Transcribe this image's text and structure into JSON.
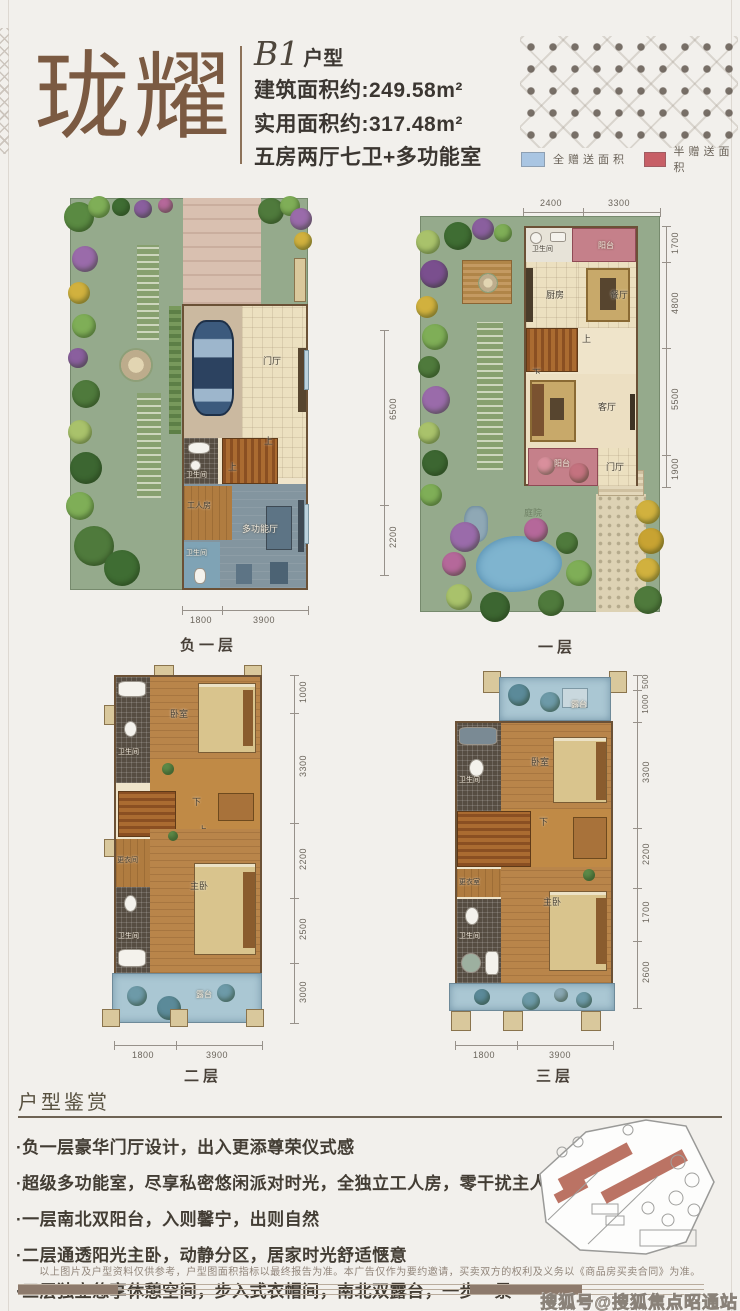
{
  "header": {
    "title": "珑耀",
    "unit_code": "B1",
    "unit_suffix": "户型",
    "line1": "建筑面积约:249.58m²",
    "line2": "实用面积约:317.48m²",
    "line3": "五房两厅七卫+多功能室",
    "legend": [
      {
        "label": "全赠送面积",
        "color": "#a9c5e2"
      },
      {
        "label": "半赠送面积",
        "color": "#c75f66"
      }
    ]
  },
  "plans": [
    {
      "caption": "负一层",
      "rooms": {
        "entry": "门厅",
        "bath1": "卫生间",
        "worker": "工人房",
        "multi": "多功能厅",
        "bath2": "卫生间"
      },
      "stair_up": "上",
      "dims_right": [
        "6500",
        "2200"
      ],
      "dims_bottom": [
        "1800",
        "3900"
      ]
    },
    {
      "caption": "一层",
      "rooms": {
        "bath": "卫生间",
        "balcony_n": "阳台",
        "kitchen": "厨房",
        "dining": "餐厅",
        "living": "客厅",
        "balcony_s": "阳台",
        "entry": "门厅",
        "courtyard": "庭院"
      },
      "stair_up": "上",
      "stair_down": "下",
      "dims_top": [
        "2400",
        "3300"
      ],
      "dims_right": [
        "1700",
        "4800",
        "5500",
        "1900"
      ]
    },
    {
      "caption": "二层",
      "rooms": {
        "bedroom": "卧室",
        "bath1": "卫生间",
        "closet": "更衣间",
        "master": "主卧",
        "bath2": "卫生间",
        "terrace": "露台"
      },
      "stair_up": "上",
      "stair_down": "下",
      "dims_right": [
        "1000",
        "3300",
        "2200",
        "2500",
        "3000"
      ],
      "dims_bottom": [
        "1800",
        "3900"
      ]
    },
    {
      "caption": "三层",
      "rooms": {
        "terrace_n": "露台",
        "bath1": "卫生间",
        "bedroom": "卧室",
        "closet": "更衣室",
        "master": "主卧",
        "bath2": "卫生间"
      },
      "stair_down": "下",
      "dims_right": [
        "500",
        "1000",
        "3300",
        "2200",
        "1700",
        "2600"
      ],
      "dims_bottom": [
        "1800",
        "3900"
      ]
    }
  ],
  "appreciation": {
    "title": "户型鉴赏",
    "bullets": [
      "·负一层豪华门厅设计，出入更添尊荣仪式感",
      "·超级多功能室，尽享私密悠闲派对时光，全独立工人房，零干扰主人生活",
      "·一层南北双阳台，入则馨宁，出则自然",
      "·二层通透阳光主卧，动静分区，居家时光舒适惬意",
      "·三层独立悠享休憩空间，步入式衣帽间，南北双露台，一步一景"
    ]
  },
  "footer": {
    "disclaimer": "以上图片及户型资料仅供参考，户型图面积指标以最终报告为准。本广告仅作为要约邀请，买卖双方的权利及义务以《商品房买卖合同》为准。",
    "watermark": "搜狐号@搜狐焦点昭通站"
  }
}
